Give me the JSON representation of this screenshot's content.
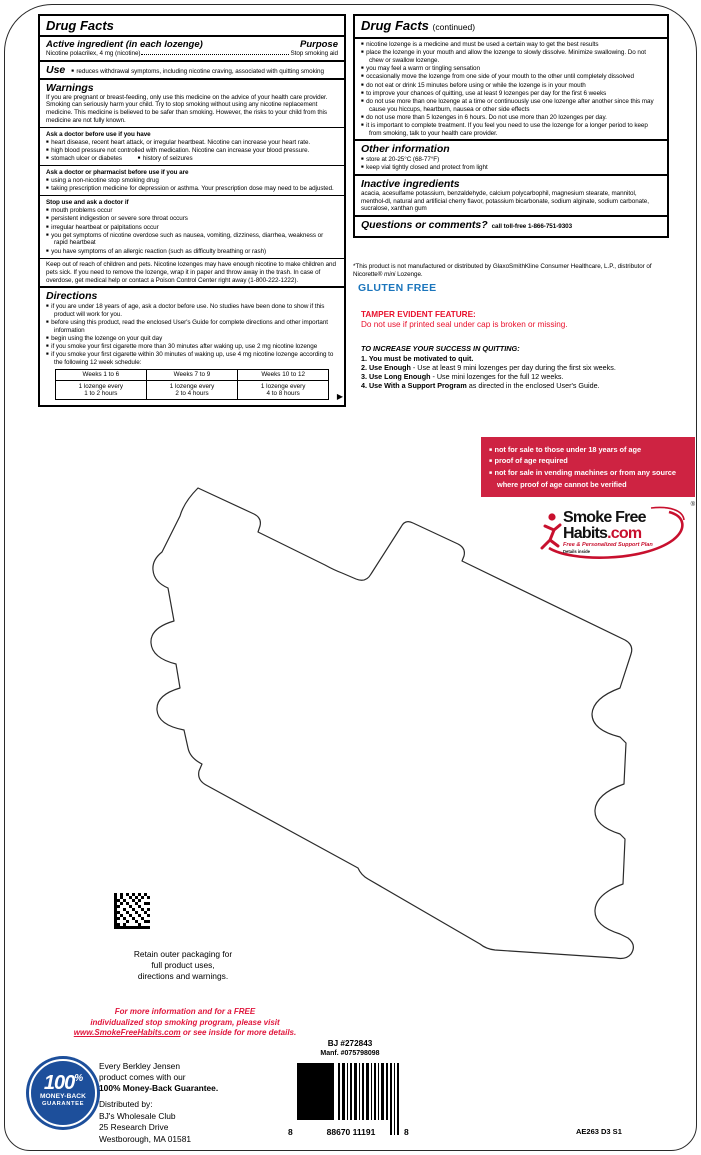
{
  "left_panel": {
    "title": "Drug Facts",
    "active": {
      "heading": "Active ingredient (in each lozenge)",
      "purpose_label": "Purpose",
      "ingredient": "Nicotine polacrilex, 4 mg (nicotine)",
      "purpose_value": "Stop smoking aid"
    },
    "use": {
      "label": "Use",
      "text": "reduces withdrawal symptoms, including nicotine craving, associated with quitting smoking"
    },
    "warnings": {
      "heading": "Warnings",
      "intro": "If you are pregnant or breast-feeding, only use this medicine on the advice of your health care provider. Smoking can seriously harm your child. Try to stop smoking without using any nicotine replacement medicine. This medicine is believed to be safer than smoking. However, the risks to your child from this medicine are not fully known.",
      "ask_doctor": {
        "heading": "Ask a doctor before use if you have",
        "bullets": [
          "heart disease, recent heart attack, or irregular heartbeat. Nicotine can increase your heart rate.",
          "high blood pressure not controlled with medication. Nicotine can increase your blood pressure.",
          "stomach ulcer or diabetes",
          "history of seizures"
        ]
      },
      "ask_pharmacist": {
        "heading": "Ask a doctor or pharmacist before use if you are",
        "bullets": [
          "using a non-nicotine stop smoking drug",
          "taking prescription medicine for depression or asthma. Your prescription dose may need to be adjusted."
        ]
      },
      "stop_use": {
        "heading": "Stop use and ask a doctor if",
        "bullets": [
          "mouth problems occur",
          "persistent indigestion or severe sore throat occurs",
          "irregular heartbeat or palpitations occur",
          "you get symptoms of nicotine overdose such as nausea, vomiting, dizziness, diarrhea, weakness or rapid heartbeat",
          "you have symptoms of an allergic reaction (such as difficulty breathing or rash)"
        ]
      },
      "keep_out": "Keep out of reach of children and pets. Nicotine lozenges may have enough nicotine to make children and pets sick. If you need to remove the lozenge, wrap it in paper and throw away in the trash. In case of overdose, get medical help or contact a Poison Control Center right away (1-800-222-1222)."
    },
    "directions": {
      "heading": "Directions",
      "bullets": [
        "if you are under 18 years of age, ask a doctor before use. No studies have been done to show if this product will work for you.",
        "before using this product, read the enclosed User's Guide for complete directions and other important information",
        "begin using the lozenge on your quit day",
        "if you smoke your first cigarette more than 30 minutes after waking up, use 2 mg nicotine lozenge",
        "if you smoke your first cigarette within 30 minutes of waking up, use 4 mg nicotine lozenge according to the following 12 week schedule:"
      ],
      "table": {
        "headers": [
          "Weeks 1 to 6",
          "Weeks 7 to 9",
          "Weeks 10 to 12"
        ],
        "cells": [
          {
            "l1": "1 lozenge every",
            "l2": "1 to 2 hours"
          },
          {
            "l1": "1 lozenge every",
            "l2": "2 to 4 hours"
          },
          {
            "l1": "1 lozenge every",
            "l2": "4 to 8 hours"
          }
        ]
      },
      "continued_arrow": "▶"
    }
  },
  "right_panel": {
    "title": "Drug Facts",
    "title_suffix": "(continued)",
    "bullets": [
      "nicotine lozenge is a medicine and must be used a certain way to get the best results",
      "place the lozenge in your mouth and allow the lozenge to slowly dissolve. Minimize swallowing. Do not chew or swallow lozenge.",
      "you may feel a warm or tingling sensation",
      "occasionally move the lozenge from one side of your mouth to the other until completely dissolved",
      "do not eat or drink 15 minutes before using or while the lozenge is in your mouth",
      "to improve your chances of quitting, use at least 9 lozenges per day for the first 6 weeks",
      "do not use more than one lozenge at a time or continuously use one lozenge after another since this may cause you hiccups, heartburn, nausea or other side effects",
      "do not use more than 5 lozenges in 6 hours. Do not use more than 20 lozenges per day.",
      "it is important to complete treatment. If you feel you need to use the lozenge for a longer period to keep from smoking, talk to your health care provider."
    ],
    "other_info": {
      "heading": "Other information",
      "bullets": [
        "store at 20-25°C (68-77°F)",
        "keep vial tightly closed and protect from light"
      ]
    },
    "inactive": {
      "heading": "Inactive ingredients",
      "text": "acacia, acesulfame potassium, benzaldehyde, calcium polycarbophil, magnesium stearate, mannitol, menthol-dl, natural and artificial cherry flavor, potassium bicarbonate, sodium alginate, sodium carbonate, sucralose, xanthan gum"
    },
    "questions": {
      "heading": "Questions or comments?",
      "text": "call toll-free 1-866-751-9303"
    }
  },
  "notices": {
    "disclaimer_1": "*This product is not manufactured or distributed by GlaxoSmithKline Consumer Healthcare, L.P., distributor of Nicorette® ",
    "disclaimer_mini": "mini",
    "disclaimer_2": " Lozenge.",
    "gluten_free": "GLUTEN FREE",
    "tamper_heading": "TAMPER EVIDENT FEATURE:",
    "tamper_text": "Do not use if printed seal under cap is broken or missing.",
    "success_heading": "TO INCREASE YOUR SUCCESS IN QUITTING:",
    "success_steps": [
      {
        "bold": "1. You must be motivated to quit.",
        "rest": ""
      },
      {
        "bold": "2. Use Enough",
        "rest": " - Use at least 9 mini lozenges per day during the first six weeks."
      },
      {
        "bold": "3. Use Long Enough",
        "rest": " - Use mini lozenges for the full 12 weeks."
      },
      {
        "bold": "4. Use With a Support Program",
        "rest": " as directed in the enclosed User's Guide."
      }
    ],
    "age_bullets": [
      "not for sale to those under 18 years of age",
      "proof of age required",
      "not for sale in vending machines or from any source where proof of age cannot be verified"
    ]
  },
  "logo": {
    "line1": "Smoke Free",
    "line2_black": "Habits",
    "line2_red": ".com",
    "tagline": "Free & Personalized Support Plan",
    "sub": "Details inside",
    "reg": "®"
  },
  "bottom": {
    "retain_lines": [
      "Retain outer packaging for",
      "full product uses,",
      "directions and warnings."
    ],
    "promo_line1": "For more information and for a FREE",
    "promo_line2": "individualized stop smoking program, please visit",
    "promo_link": "www.SmokeFreeHabits.com",
    "promo_line3_rest": " or see inside for more details.",
    "seal": {
      "pct": "100",
      "pct_sign": "%",
      "line2": "MONEY-BACK",
      "line3": "GUARANTEE"
    },
    "guarantee_lines": [
      "Every Berkley Jensen",
      "product comes with our"
    ],
    "guarantee_bold": "100% Money-Back Guarantee.",
    "distributed": [
      "Distributed by:",
      "BJ's Wholesale Club",
      "25 Research Drive",
      "Westborough, MA 01581"
    ],
    "bj_number": "BJ #272843",
    "manf_number": "Manf. #075798098",
    "barcode": {
      "left_digit": "8",
      "digits": "88670 11191",
      "right_digit": "8"
    },
    "plate_code": "AE263 D3 S1"
  },
  "colors": {
    "age_box_red": "#CE2342",
    "accent_red": "#E8112D",
    "gluten_blue": "#1B75BC",
    "seal_blue": "#1D4F9B"
  }
}
